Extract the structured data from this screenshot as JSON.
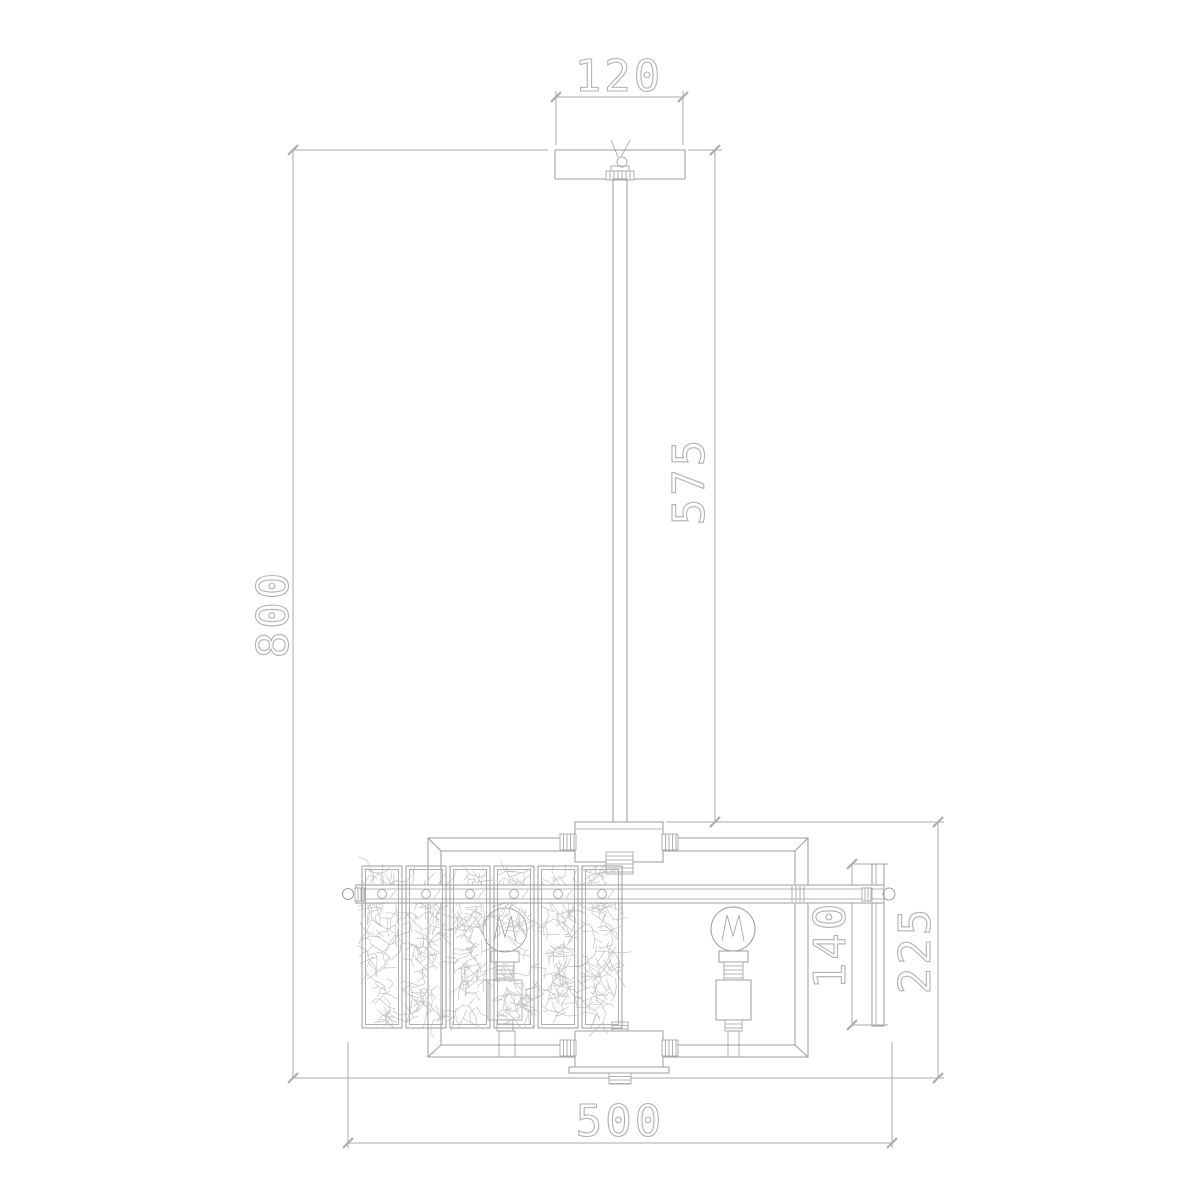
{
  "drawing": {
    "dimensions": {
      "canopy_width": "120",
      "rod_length": "575",
      "overall_height": "800",
      "side_panel_height": "140",
      "body_height": "225",
      "body_width": "500"
    },
    "colors": {
      "background": "#ffffff",
      "fixture_line": "#9e9e9e",
      "dimension_line": "#ababab",
      "dimension_text": "#b2b2b2",
      "crystal_texture": "#c4c4c4"
    }
  }
}
